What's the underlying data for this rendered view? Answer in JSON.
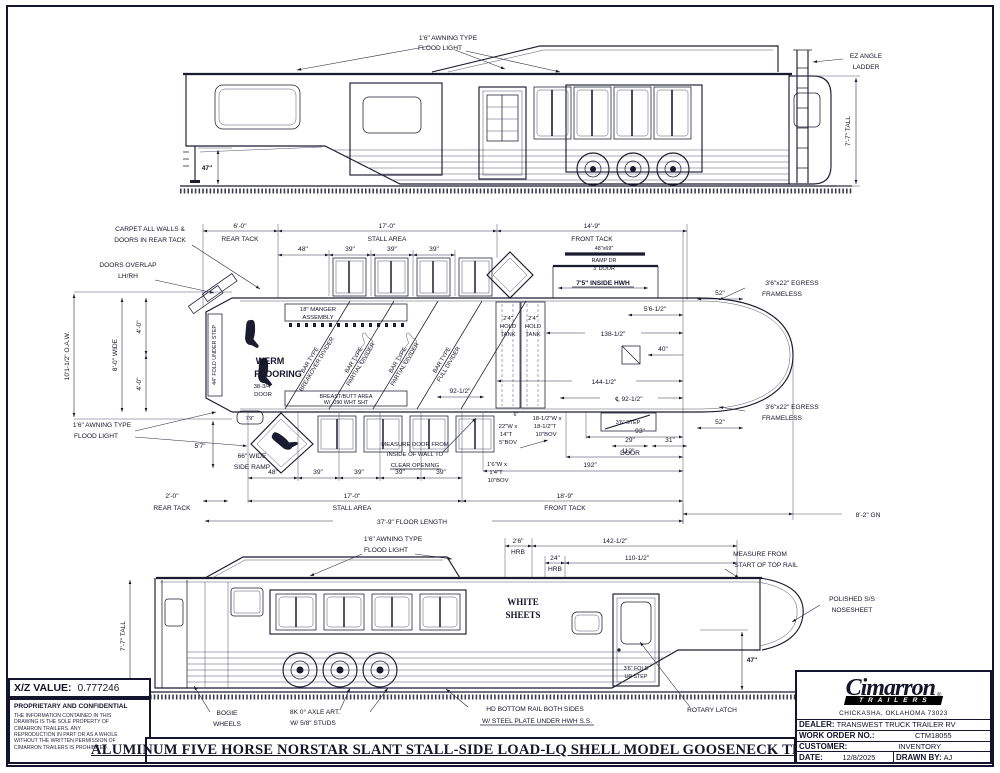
{
  "sheet": {
    "main_title": "ALUMINUM FIVE HORSE NORSTAR SLANT STALL-SIDE LOAD-LQ SHELL MODEL GOOSENECK TRAILER",
    "xz_label": "X/Z VALUE:",
    "xz_value": "0.777246",
    "conf_title": "PROPRIETARY AND CONFIDENTIAL",
    "conf": [
      "THE INFORMATION CONTAINED IN THIS",
      "DRAWING IS THE SOLE PROPERTY OF",
      "CIMARRON TRAILERS.  ANY",
      "REPRODUCTION IN PART OR AS A WHOLE",
      "WITHOUT THE WRITTEN PERMISSION OF",
      "CIMARRON TRAILERS IS PROHIBITED."
    ]
  },
  "title_block": {
    "brand": "Cimarron",
    "brand_sub": "TRAILERS",
    "reg": "®",
    "address": "CHICKASHA, OKLAHOMA 73023",
    "dealer_label": "DEALER:",
    "dealer": "TRANSWEST TRUCK TRAILER RV",
    "wo_label": "WORK ORDER NO.:",
    "wo": "CTM18055",
    "cust_label": "CUSTOMER:",
    "cust": "INVENTORY",
    "date_label": "DATE:",
    "date": "12/8/2025",
    "drawn_label": "DRAWN BY:",
    "drawn": "AJ"
  },
  "top_view": {
    "flood1": "1'6\" AWNING TYPE",
    "flood2": "FLOOD LIGHT",
    "ladder1": "EZ ANGLE",
    "ladder2": "LADDER",
    "tall": "7'-7\" TALL",
    "d47": "47\""
  },
  "plan": {
    "rear_top_v": "6'-0\"",
    "rear_top_l": "REAR TACK",
    "stall_top_v": "17'-0\"",
    "stall_top_l": "STALL AREA",
    "front_top_v": "14'-9\"",
    "front_top_l": "FRONT TACK",
    "sp_top": [
      "48\"",
      "39\"",
      "39\"",
      "39\""
    ],
    "carpet1": "CARPET ALL WALLS &",
    "carpet2": "DOORS IN REAR TACK",
    "overlap1": "DOORS OVERLAP",
    "overlap2": "LH/RH",
    "oaw": "10'1-1/2\" O.A.W.",
    "wide": "8'-0\" WIDE",
    "ft4a": "4'-0\"",
    "ft4b": "4'-0\"",
    "fold": "44\" FOLD UNDER STEP",
    "werm1": "WERM",
    "werm2": "FLOORING",
    "d3834a": "38-3/4\"",
    "d3834b": "DOOR",
    "d79": "79\"",
    "ramp1": "66\" WIDE",
    "ramp2": "SIDE RAMP",
    "flood1": "1'6\" AWNING TYPE",
    "flood2": "FLOOD LIGHT",
    "d57": "5'7\"",
    "manger1": "18\" MANGER",
    "manger2": "ASSEMBLY",
    "butt1": "BREAST/BUTT AREA",
    "butt2": "W/ .090 WHT SHT",
    "dividers": [
      {
        "a": "BAR TYPE",
        "b": "BREAKOVER DIVIDER"
      },
      {
        "a": "BAR TYPE",
        "b": "PARTIAL DIVIDER"
      },
      {
        "a": "BAR TYPE",
        "b": "PARTIAL DIVIDER"
      },
      {
        "a": "BAR TYPE",
        "b": "FULL DIVIDER"
      }
    ],
    "tank": [
      "2'4\"",
      "HOLD",
      "TANK"
    ],
    "hwh": "7'5\" INSIDE HWH",
    "rampdr1": "48\"x69\"",
    "rampdr2": "RAMP DR",
    "rampdr3": "3' DOOR",
    "d5612": "5'6-1/2\"",
    "d13812": "138-1/2\"",
    "d40": "40\"",
    "d14412": "144-1/2\"",
    "d9212c": "℄ 92-1/2\"",
    "d9212": "92-1/2\"",
    "egress1": "3'6\"x22\" EGRESS",
    "egress2": "FRAMELESS",
    "d52": "52\"",
    "step36": "3'6\" STEP",
    "d6": "6\"",
    "door29a": "29\"",
    "door29b": "DOOR",
    "d31": "31\"",
    "d93": "93\"",
    "d112": "112\"",
    "d192": "192\"",
    "bovA": [
      "22\"W x",
      "14\"T",
      "5\"BOV"
    ],
    "bovB": [
      "18-1/2\"W x",
      "18-1/2\"T",
      "10\"BOV"
    ],
    "bovC": [
      "1'6\"W x",
      "1'4\"T",
      "10\"BOV"
    ],
    "meas1": "MEASURE DOOR FROM",
    "meas2": "INSIDE OF WALL TO",
    "meas3": "CLEAR OPENING",
    "rear_bot_v": "2'-0\"",
    "rear_bot_l": "REAR TACK",
    "stall_bot_v": "17'-0\"",
    "stall_bot_l": "STALL AREA",
    "front_bot_v": "18'-9\"",
    "front_bot_l": "FRONT TACK",
    "sp_bot": [
      "48\"",
      "39\"",
      "39\"",
      "39\"",
      "39\""
    ],
    "floor_len": "37'-9\" FLOOR LENGTH",
    "gn": "8'-2\" GN"
  },
  "side": {
    "flood1": "1'6\" AWNING TYPE",
    "flood2": "FLOOD LIGHT",
    "hrb26a": "2'6\"",
    "hrb26b": "HRB",
    "hrb24a": "24\"",
    "hrb24b": "HRB",
    "d14212": "142-1/2\"",
    "d11012": "110-1/2\"",
    "measr1": "MEASURE FROM",
    "measr2": "START OF TOP RAIL",
    "white1": "WHITE",
    "white2": "SHEETS",
    "nose1": "POLISHED S/S",
    "nose2": "NOSESHEET",
    "tall": "7'-7\" TALL",
    "d47": "47\"",
    "fold1": "3'6\" FOLD",
    "fold2": "UP STEP",
    "bogie1": "BOGIE",
    "bogie2": "WHEELS",
    "axle1": "8K 0° AXLE ART.",
    "axle2": "W/ 5/8\" STUDS",
    "hd1": "HD BOTTOM RAIL BOTH SIDES",
    "hd2": "W/ STEEL PLATE UNDER HWH S.S.",
    "rotary": "ROTARY LATCH"
  }
}
